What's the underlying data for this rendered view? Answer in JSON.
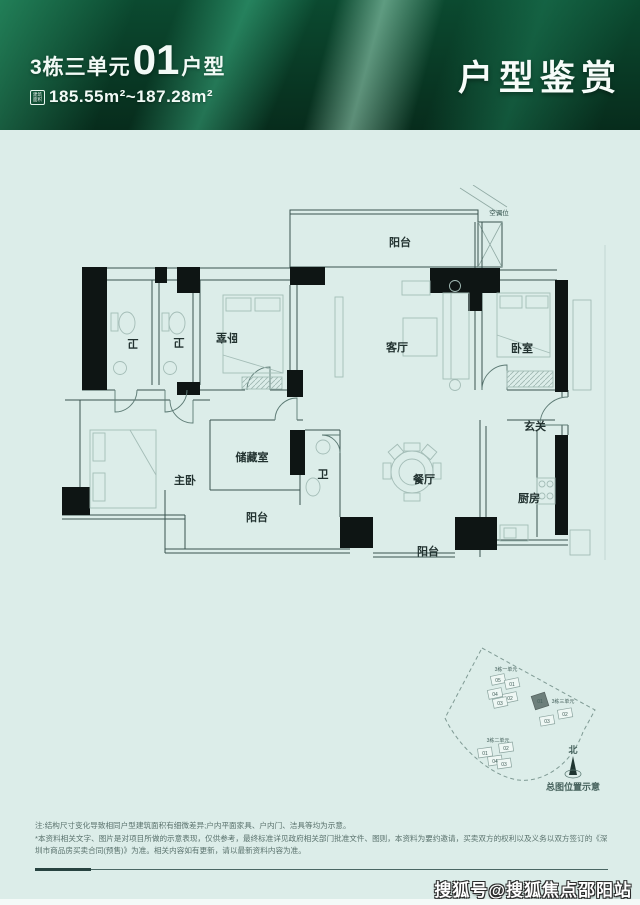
{
  "header": {
    "unit_prefix": "3栋三单元",
    "unit_number": "01",
    "unit_suffix": "户型",
    "area_icon_line1": "建筑",
    "area_icon_line2": "面积",
    "area_text": "185.55m²~187.28m²",
    "page_title": "户型鉴赏"
  },
  "floor_plan": {
    "rooms": [
      {
        "id": "balcony-top",
        "label": "阳台"
      },
      {
        "id": "ac-slot",
        "label": "空调位"
      },
      {
        "id": "bath-1",
        "label": "卫"
      },
      {
        "id": "bath-2",
        "label": "卫"
      },
      {
        "id": "bedroom-left",
        "label": "卧室"
      },
      {
        "id": "living",
        "label": "客厅"
      },
      {
        "id": "bedroom-right",
        "label": "卧室"
      },
      {
        "id": "entry",
        "label": "玄关"
      },
      {
        "id": "master",
        "label": "主卧"
      },
      {
        "id": "storage",
        "label": "储藏室"
      },
      {
        "id": "bath-3",
        "label": "卫"
      },
      {
        "id": "balcony-left",
        "label": "阳台"
      },
      {
        "id": "dining",
        "label": "餐厅"
      },
      {
        "id": "kitchen",
        "label": "厨房"
      },
      {
        "id": "balcony-bottom",
        "label": "阳台"
      }
    ]
  },
  "site_map": {
    "clusters": [
      {
        "name": "3栋一单元",
        "units": [
          "05",
          "01",
          "04",
          "02",
          "03"
        ]
      },
      {
        "name": "3栋三单元",
        "units": [
          "01",
          "02",
          "03"
        ],
        "highlighted": "01"
      },
      {
        "name": "3栋二单元",
        "units": [
          "02",
          "01",
          "04",
          "03"
        ]
      }
    ],
    "north_label": "北",
    "caption": "总图位置示意"
  },
  "disclaimer": {
    "line1": "注:结构尺寸变化导致相同户型建筑面积有细微差异;户内平面家具、户内门、洁具等均为示意。",
    "line2": "*本资料相关文字、图片是对项目所做的示意表现，仅供参考，最终标准详见政府相关部门批准文件、图则，本资料为要约邀请，买卖双方的权利以及义务以双方签订的《深",
    "line3": "圳市商品房买卖合同(预售)》为准。相关内容如有更新，请以最新资料内容为准。"
  },
  "watermark": "搜狐号@搜狐焦点邵阳站",
  "colors": {
    "banner_green": "#0b4a30",
    "page_bg": "#dcede9",
    "accent_dark": "#0e1514"
  }
}
